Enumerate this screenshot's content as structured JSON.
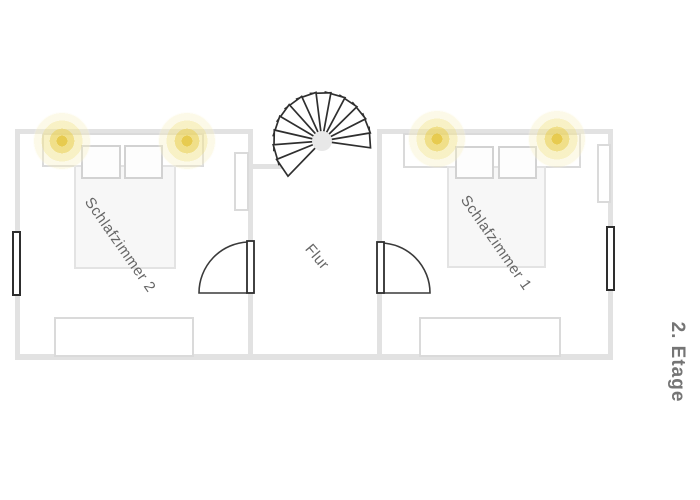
{
  "floor_label": "2. Etage",
  "rooms": {
    "bedroom2": {
      "label": "Schlafzimmer 2",
      "features": [
        "double-bed",
        "two-pillows",
        "two-ceiling-lamps",
        "window-on-left-wall",
        "door-to-hallway",
        "wardrobe",
        "dresser"
      ]
    },
    "hallway": {
      "label": "Flur",
      "features": [
        "spiral-staircase",
        "door-to-bedroom-2",
        "door-to-bedroom-1"
      ]
    },
    "bedroom1": {
      "label": "Schlafzimmer 1",
      "features": [
        "double-bed",
        "two-pillows",
        "two-ceiling-lamps",
        "window-on-right-wall",
        "door-to-hallway",
        "wardrobe",
        "dresser"
      ]
    }
  },
  "colors": {
    "background": "#ffffff",
    "wall": "#e2e2e2",
    "furniture_outline": "#d8d8d8",
    "bed_fill": "#f7f7f7",
    "dark_outline": "#2e2e2e",
    "lamp_glow_core": "#e6c846",
    "room_label_text": "#666666",
    "floor_label_text": "#757575"
  },
  "stairs": {
    "center_x": 322,
    "center_y": 141,
    "radius": 49,
    "steps": 13,
    "start_angle_deg": -8,
    "step_angle_deg": 17.5,
    "wedge_span_deg": 24
  }
}
